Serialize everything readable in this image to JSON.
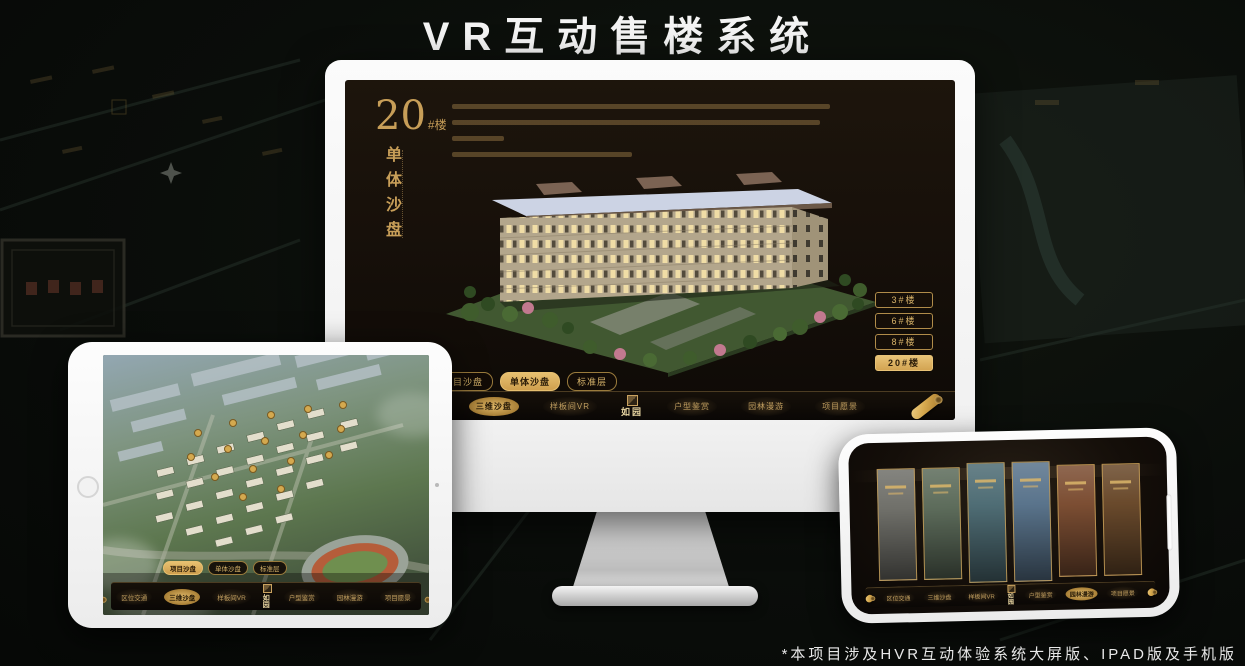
{
  "title": "VR互动售楼系统",
  "footnote": "*本项目涉及HVR互动体验系统大屏版、IPAD版及手机版",
  "colors": {
    "gold": "#c9a25f",
    "gold_active": "#ddb266",
    "screen_bg": "#16100a",
    "device_white": "#f5f5f5"
  },
  "monitor": {
    "block_number": "20",
    "block_unit": "#楼",
    "block_subtitle": "单体沙盘",
    "building_buttons": [
      {
        "label": "3#楼",
        "active": false
      },
      {
        "label": "6#楼",
        "active": false
      },
      {
        "label": "8#楼",
        "active": false
      },
      {
        "label": "20#楼",
        "active": true
      }
    ],
    "tabs": [
      {
        "label": "项目沙盘",
        "active": false
      },
      {
        "label": "单体沙盘",
        "active": true
      },
      {
        "label": "标准层",
        "active": false
      }
    ],
    "nav": {
      "items": [
        "区位交通",
        "三维沙盘",
        "样板间VR",
        "户型鉴赏",
        "园林漫游",
        "项目愿景"
      ],
      "active": "三维沙盘",
      "logo": "如园"
    }
  },
  "tablet": {
    "tabs": [
      {
        "label": "项目沙盘",
        "active": true
      },
      {
        "label": "单体沙盘",
        "active": false
      },
      {
        "label": "标准层",
        "active": false
      }
    ],
    "nav": {
      "items": [
        "区位交通",
        "三维沙盘",
        "样板间VR",
        "户型鉴赏",
        "园林漫游",
        "项目愿景"
      ],
      "active": "三维沙盘",
      "logo": "如园"
    }
  },
  "phone": {
    "nav": {
      "items": [
        "区位交通",
        "三维沙盘",
        "样板间VR",
        "户型鉴赏",
        "园林漫游",
        "项目愿景"
      ],
      "active": "园林漫游",
      "logo": "如园"
    },
    "cards": [
      {
        "color": "#70706a"
      },
      {
        "color": "#5d6c5b"
      },
      {
        "color": "#4f6d75"
      },
      {
        "color": "#5a748c"
      },
      {
        "color": "#7c4e33"
      },
      {
        "color": "#6a4a2c"
      }
    ]
  }
}
